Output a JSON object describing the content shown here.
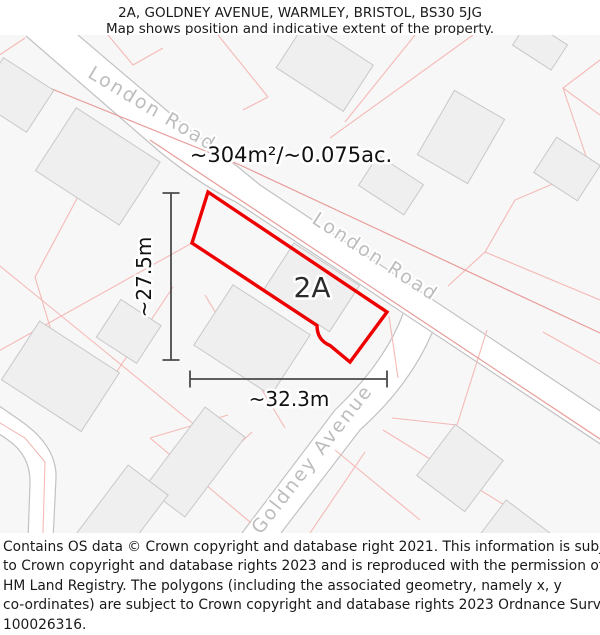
{
  "header": {
    "title": "2A, GOLDNEY AVENUE, WARMLEY, BRISTOL, BS30 5JG",
    "subtitle": "Map shows position and indicative extent of the property."
  },
  "map": {
    "area_label": "~304m²/~0.075ac.",
    "property_label": "2A",
    "dimension_height": "~27.5m",
    "dimension_width": "~32.3m",
    "road_labels": {
      "london_road": "London Road",
      "goldney_avenue": "Goldney Avenue"
    },
    "colors": {
      "property_outline": "#ee0000",
      "parcel_line": "#f4b9b6",
      "parcel_line_strong": "#e89d99",
      "road_edge": "#c2c2c2",
      "building_fill": "#f0efef",
      "building_stroke": "#c8c8c8",
      "road_label": "#bdbdbd",
      "dimension": "#4a4a4a",
      "map_background": "#f8f7f7"
    }
  },
  "footer": {
    "lines": [
      "Contains OS data © Crown copyright and database right 2021. This information is subject",
      "to Crown copyright and database rights 2023 and is reproduced with the permission of",
      "HM Land Registry. The polygons (including the associated geometry, namely x, y",
      "co-ordinates) are subject to Crown copyright and database rights 2023 Ordnance Survey",
      "100026316."
    ]
  }
}
